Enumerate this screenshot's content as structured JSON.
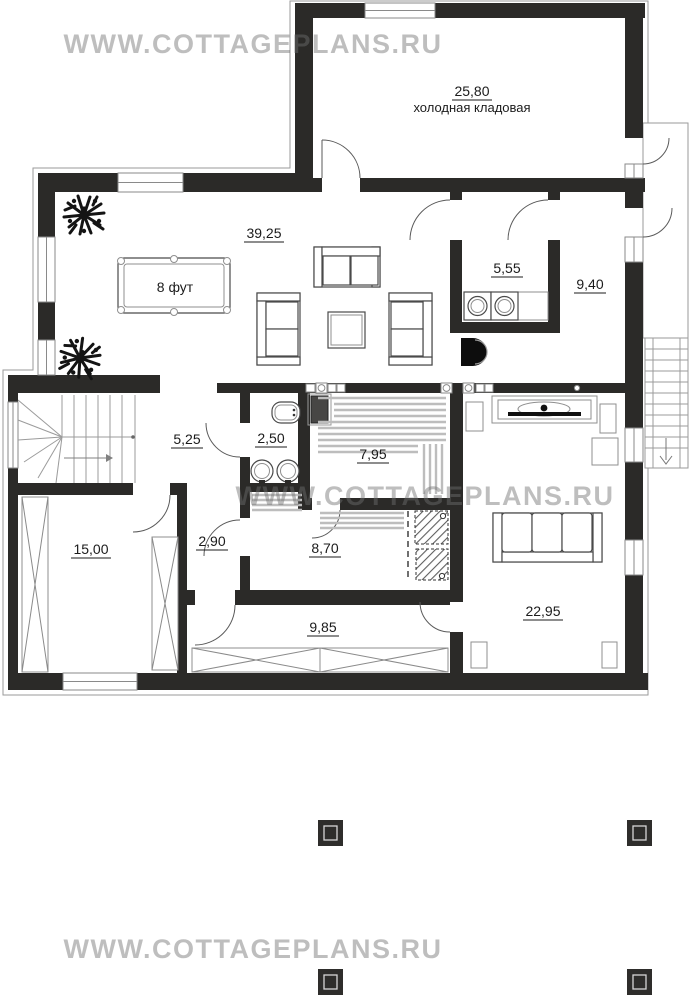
{
  "watermark": {
    "text": "WWW.COTTAGEPLANS.RU"
  },
  "colors": {
    "wall": "#2b2a28",
    "watermark_gray": "#c6c6c6"
  },
  "plan": {
    "billiard_table_label": "8 фут",
    "rooms": [
      {
        "key": "cold-storage",
        "area": "25,80",
        "name": "холодная кладовая"
      },
      {
        "key": "living-room",
        "area": "39,25"
      },
      {
        "key": "laundry",
        "area": "5,55"
      },
      {
        "key": "boiler-room",
        "area": "9,40"
      },
      {
        "key": "entry-hall",
        "area": "5,25"
      },
      {
        "key": "bathroom",
        "area": "2,50"
      },
      {
        "key": "sauna",
        "area": "7,95"
      },
      {
        "key": "hall",
        "area": "2,90"
      },
      {
        "key": "shower-room",
        "area": "8,70"
      },
      {
        "key": "garage",
        "area": "15,00"
      },
      {
        "key": "corridor",
        "area": "9,85"
      },
      {
        "key": "bedroom",
        "area": "22,95"
      }
    ]
  }
}
